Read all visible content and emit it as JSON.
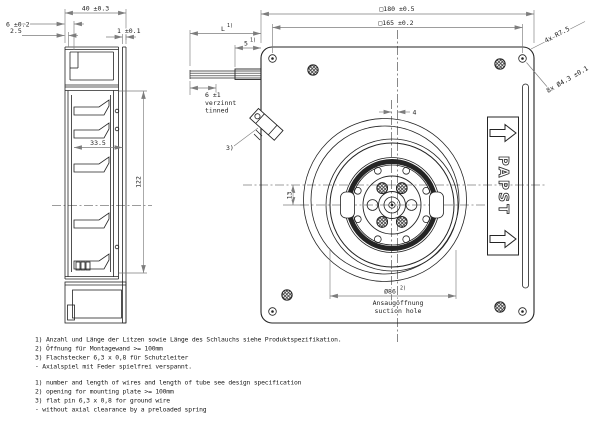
{
  "drawing": {
    "side_view": {
      "dim_depth": "40 ±0.3",
      "dim_flange": "6 ±0.2",
      "dim_lip": "2.5",
      "dim_plate_thickness": "1 ±0.1",
      "dim_inner_depth": "33.5",
      "dim_height": "122"
    },
    "front_view": {
      "dim_outer_square": "□180 ±0.5",
      "dim_mounting_square": "□165 ±0.2",
      "dim_corner_radius": "4x R7.5",
      "dim_mounting_holes": "8x Ø4.3 ±0.1",
      "dim_center_offset_x": "4",
      "dim_center_offset_y": "13",
      "dim_suction": "Ø86",
      "ref_suction": "2)",
      "label_suction_de": "Ansaugöffnung",
      "label_suction_en": "suction hole",
      "dim_wire_length": "L",
      "ref_wire_length": "1)",
      "dim_tube_length": "5",
      "ref_tube_length": "1)",
      "dim_tinned": "6 ±1",
      "label_tinned_de": "verzinnt",
      "label_tinned_en": "tinned",
      "ref_ground_pin": "3)",
      "brand": "PAPST"
    },
    "notes_de": [
      "1) Anzahl und Länge der Litzen sowie Länge des Schlauchs siehe Produktspezifikation.",
      "2) Öffnung für Montagewand >= 100mm",
      "3) Flachstecker 6,3 x 0,8 für Schutzleiter",
      "-  Axialspiel mit Feder spielfrei verspannt."
    ],
    "notes_en": [
      "1) number and length of wires and length of tube see design specification",
      "2) opening for mounting plate >= 100mm",
      "3) flat pin 6,3 x 0,8 for ground wire",
      "-  without axial clearance by a preloaded spring"
    ],
    "colors": {
      "line": "#242424",
      "dim": "#7d7d7d",
      "bg": "#ffffff"
    }
  }
}
